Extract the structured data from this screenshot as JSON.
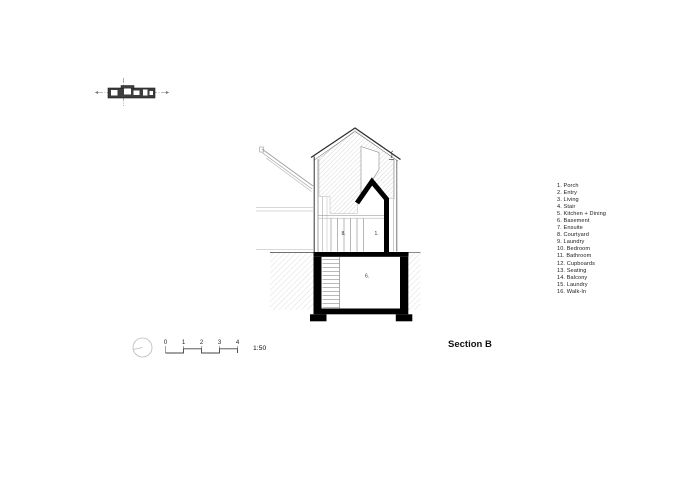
{
  "drawing": {
    "title": "Section B",
    "scale_label": "1:50",
    "scale_ticks": [
      "0",
      "1",
      "2",
      "3",
      "4"
    ],
    "room_labels": [
      {
        "id": "courtyard",
        "num": "8."
      },
      {
        "id": "porch",
        "num": "1."
      },
      {
        "id": "basement",
        "num": "6."
      }
    ]
  },
  "legend": {
    "items": [
      "1. Porch",
      "2. Entry",
      "3. Living",
      "4. Stair",
      "5. Kitchen + Dining",
      "6. Basement",
      "7. Ensuite",
      "8. Courtyard",
      "9. Laundry",
      "10. Bedroom",
      "11. Bathroom",
      "12. Cupboards",
      "13. Seating",
      "14. Balcony",
      "15. Laundry",
      "16. Walk-In"
    ]
  },
  "colors": {
    "ink": "#1a1a1a",
    "cut_black": "#000000",
    "line_dark": "#2e2e2e",
    "line_light": "#9b9b9b",
    "wall_hatch": "#cfcfcf",
    "ground_hatch": "#dcdcdc",
    "paper": "#ffffff"
  }
}
